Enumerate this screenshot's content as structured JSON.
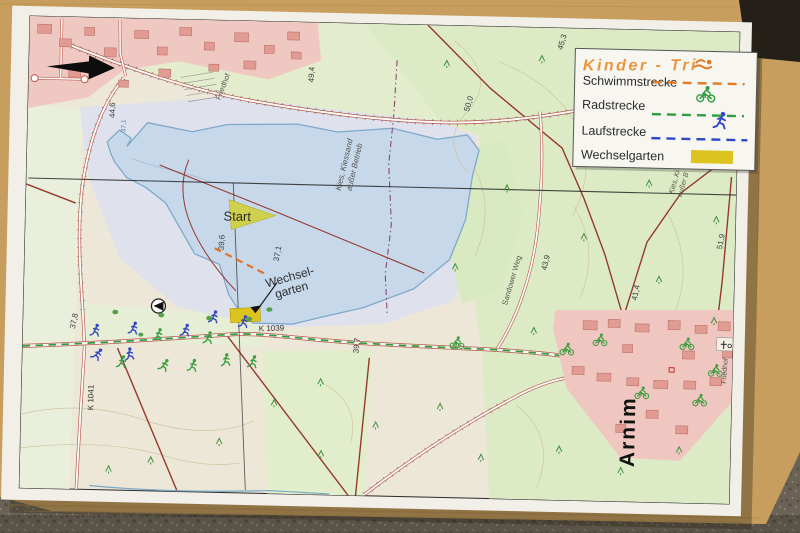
{
  "legend": {
    "title": "Kinder - Tri",
    "items": [
      {
        "label": "Schwimmstrecke",
        "color": "#e07b28",
        "icon": "swimmer-icon"
      },
      {
        "label": "Radstrecke",
        "color": "#2f9e3f",
        "icon": "cyclist-icon"
      },
      {
        "label": "Laufstrecke",
        "color": "#2f48c8",
        "icon": "runner-icon"
      },
      {
        "label": "Wechselgarten",
        "color": "#dcc31e",
        "icon": "yellow-swatch"
      }
    ]
  },
  "map": {
    "start_label": "Start",
    "transition_line1": "Wechsel-",
    "transition_line2": "garten",
    "town_name": "Arnim",
    "roads": {
      "k1039": "K 1039",
      "k1041": "K 1041",
      "sandower_weg": "Sandower Weg"
    },
    "places": {
      "cemetery_nw": "Friedhof",
      "cemetery_arnim": "Friedhof",
      "gravel_pit_l1": "Kies, Kiessand",
      "gravel_pit_l2": "außer Betrieb",
      "gravel_pit_right_l1": "Kies, Ki",
      "gravel_pit_right_l2": "außer B"
    },
    "elevations": {
      "nw_red": "44,6",
      "road_a_west": "49,4",
      "road_a_mid": "50,0",
      "north_east": "45,3",
      "lake_west": "39,6",
      "lake_level": "37,1",
      "lake_level_nw": "37,1",
      "sand_weg": "43,9",
      "east_field": "41,4",
      "far_east": "51,9",
      "k1039_mid": "39,7",
      "k1041_junction": "37,8"
    }
  },
  "colors": {
    "swim": "#e07b28",
    "bike": "#2f9e3f",
    "run": "#2f48c8",
    "transition_yellow": "#dcc31e",
    "legend_title": "#e8953e",
    "lake": "#c6d8e9",
    "board_wood": "#c79e5e"
  }
}
